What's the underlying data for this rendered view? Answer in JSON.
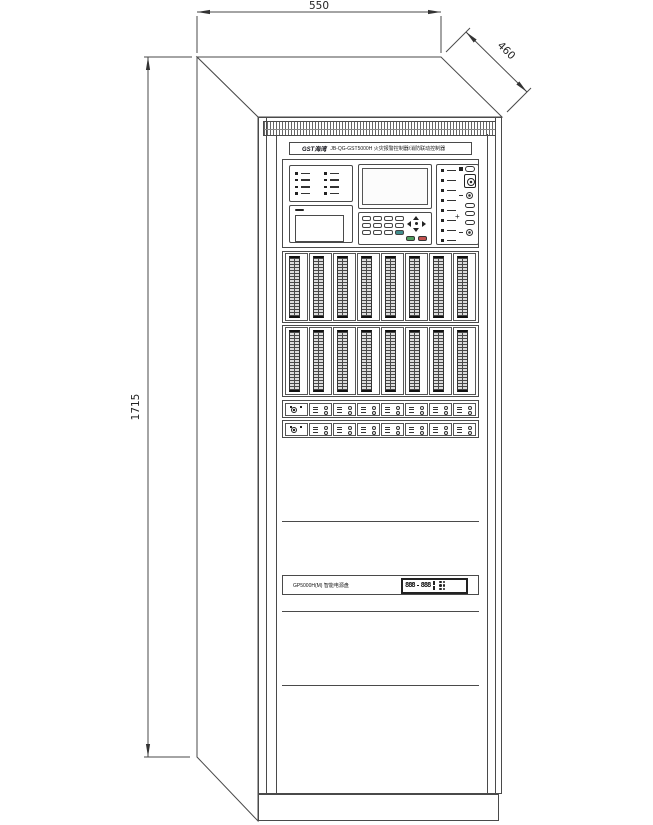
{
  "dimensions": {
    "width": "550",
    "depth": "460",
    "height": "1715"
  },
  "cabinet": {
    "header": {
      "logo": "GST海湾",
      "title": "JB-QG-GST5000H 火灾报警控制器/消防联动控制器"
    },
    "power_unit": {
      "label": "GP5000H(M) 智能电源盘",
      "display_left": "888",
      "display_right": "888"
    }
  },
  "generate": {
    "status_leds_left": 8,
    "status_leds_right": 8,
    "keypad_keys": 12,
    "loop_modules": 8,
    "relay_modules": 8,
    "cluster_dots": 6
  },
  "colors": {
    "line": "#4a4a4a",
    "dark": "#1a1a1a",
    "green_key": "#4f9e5f",
    "red_key": "#c2514f",
    "teal_key": "#418f8f"
  }
}
